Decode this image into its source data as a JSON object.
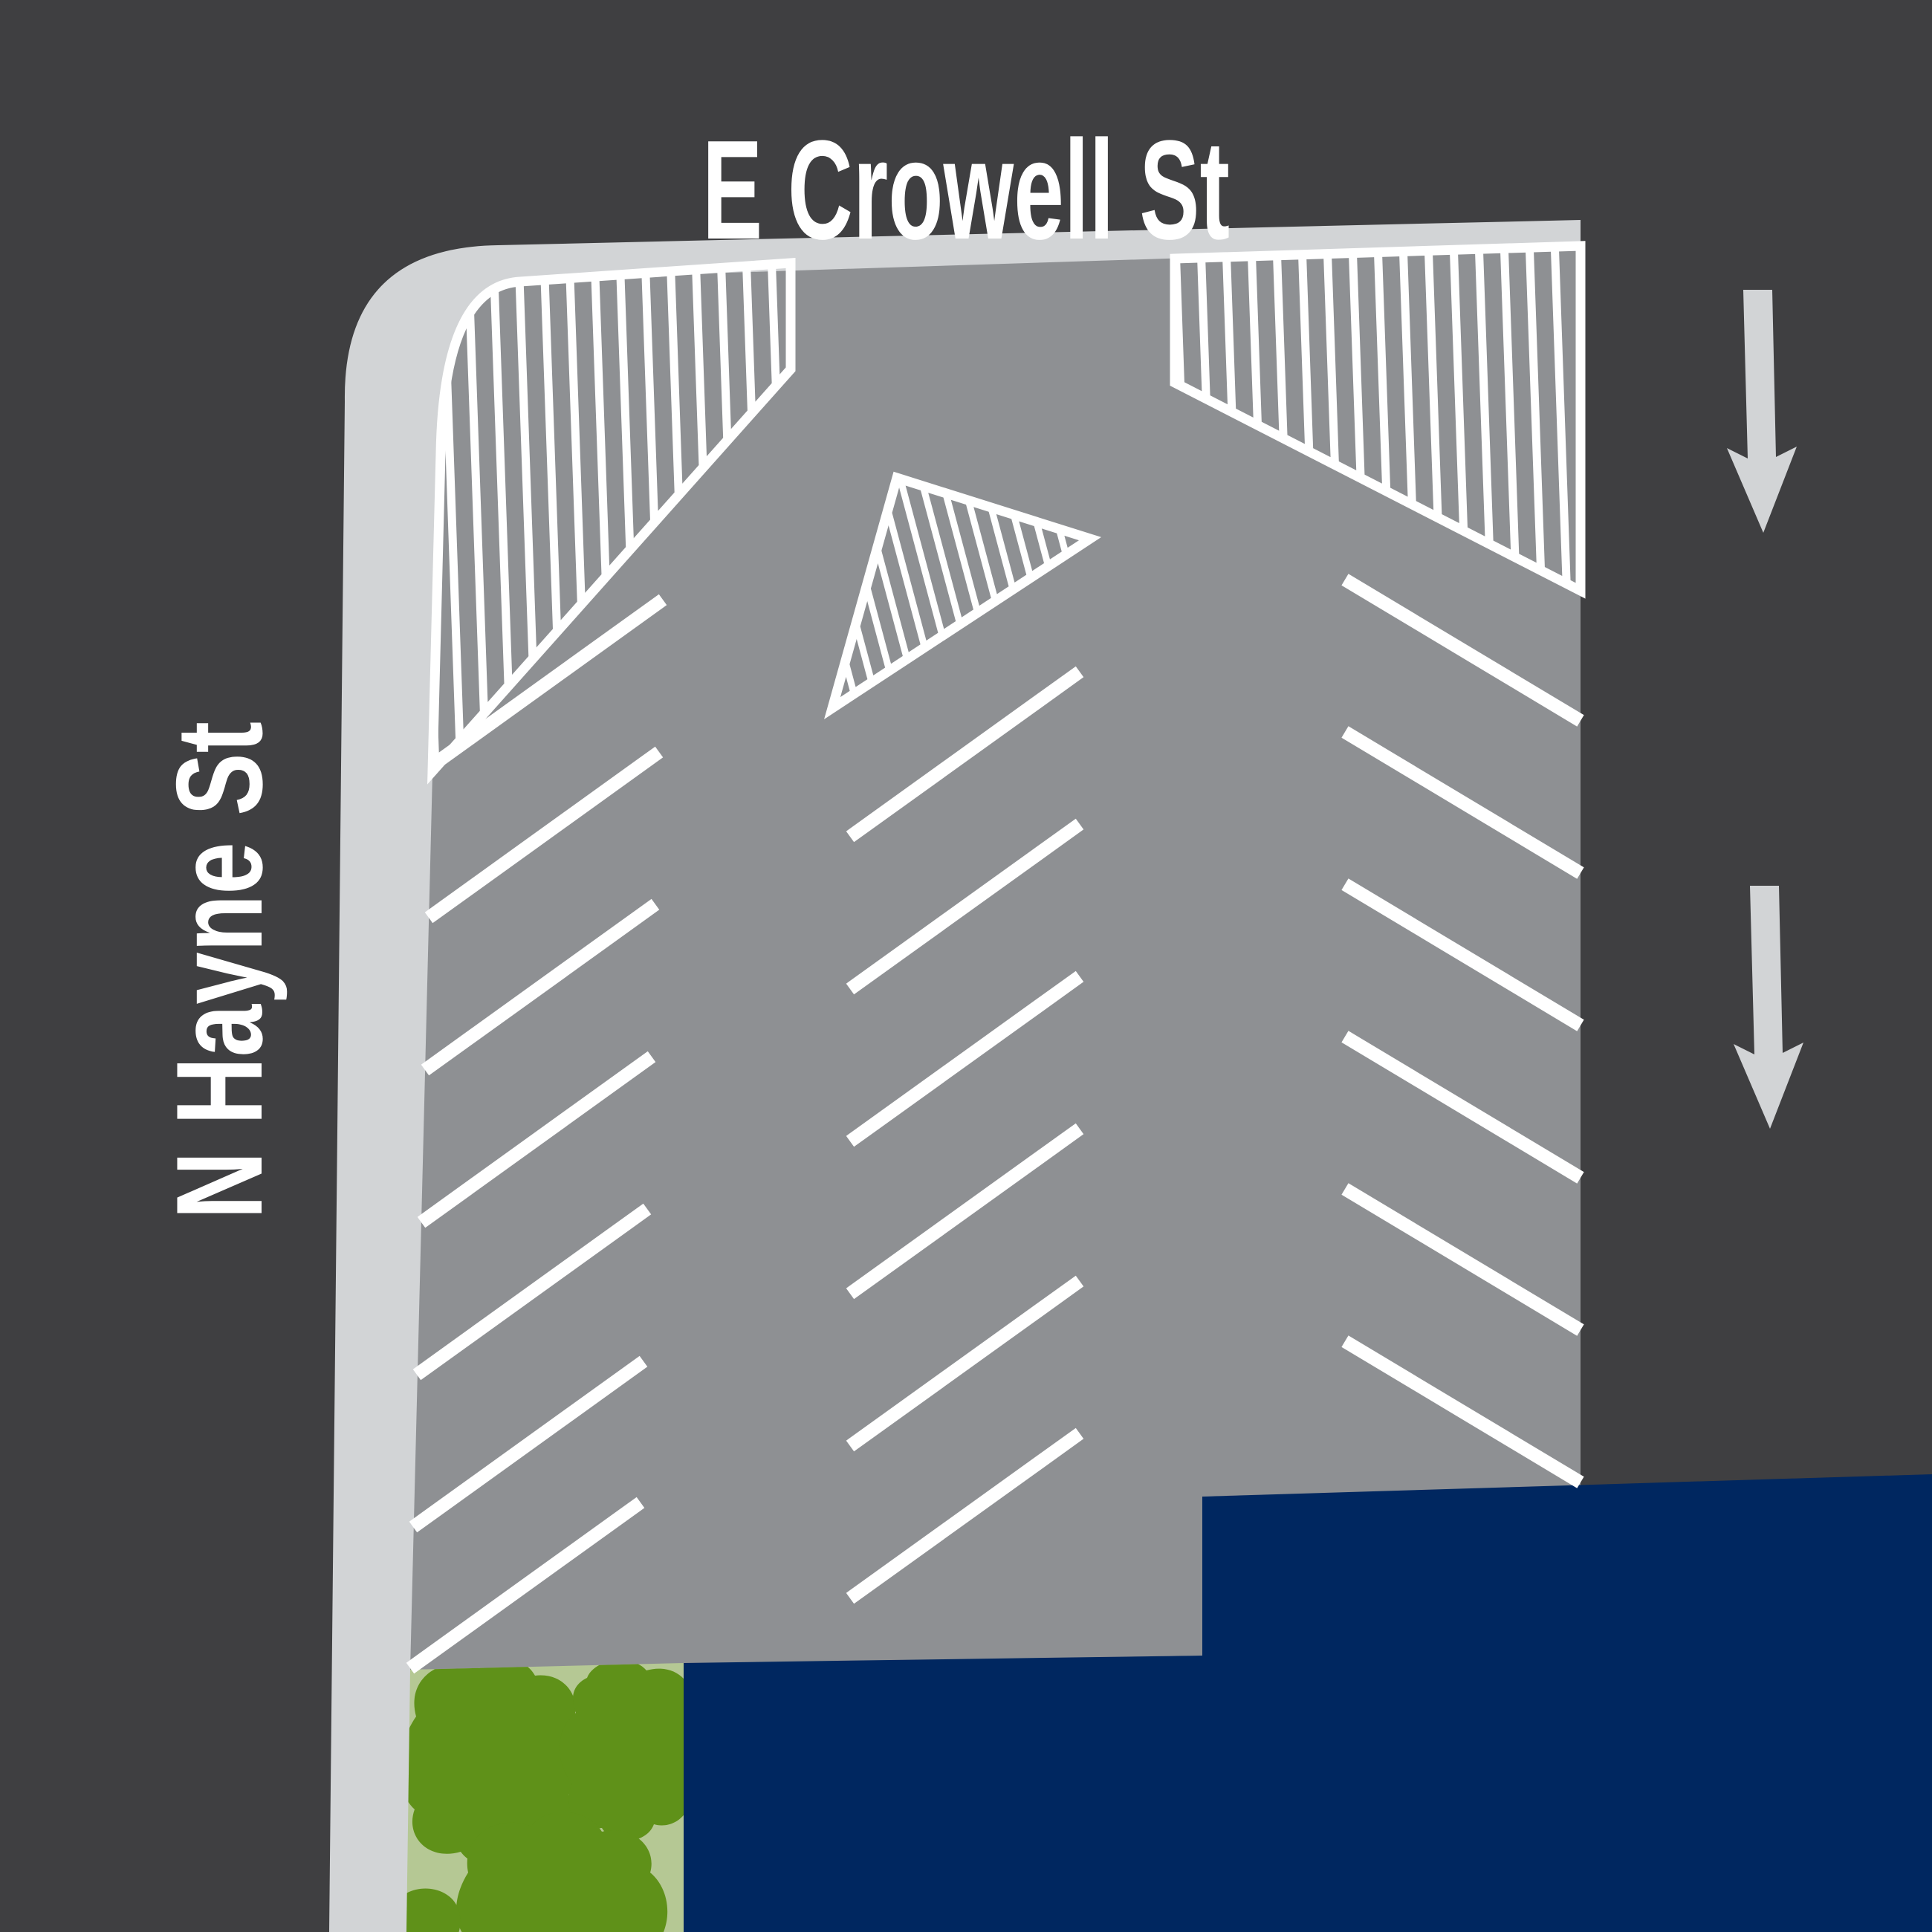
{
  "streets": {
    "top": "E Crowell St",
    "left": "N Hayne St"
  },
  "traffic": {
    "arrow_count": 2,
    "arrow_direction": "down"
  },
  "colors": {
    "background": "#3f3f41",
    "road": "#8e9093",
    "sidewalk": "#d2d4d6",
    "marking": "#ffffff",
    "building": "#002760",
    "lawn": "#b5c894",
    "shrub": "#5f9119",
    "arrow": "#d2d4d6",
    "label": "#ffffff"
  }
}
